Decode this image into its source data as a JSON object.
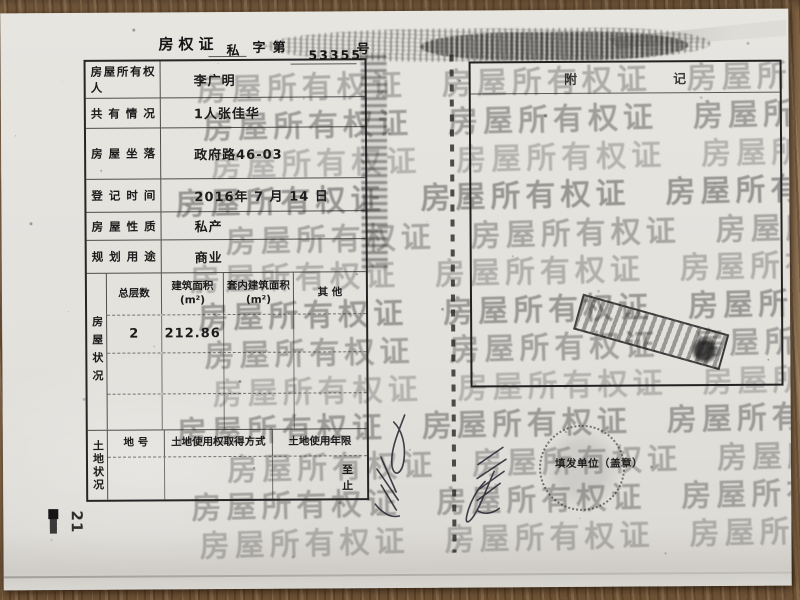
{
  "header": {
    "title": "房权证",
    "category": "私",
    "zi_di": "字第",
    "serial": "53355",
    "hao": "号"
  },
  "owner_table": {
    "rows": [
      {
        "label": "房屋所有权人",
        "value": "李广明"
      },
      {
        "label": "共有情况",
        "value": "1人张佳华"
      },
      {
        "label": "房屋坐落",
        "value": "政府路46-03"
      },
      {
        "label": "登记时间",
        "value": "2016年 7 月 14 日"
      },
      {
        "label": "房屋性质",
        "value": "私产"
      },
      {
        "label": "规划用途",
        "value": "商业"
      }
    ]
  },
  "housing": {
    "side_label": "房屋状况",
    "headers": [
      "总层数",
      "建筑面积\n(m²)",
      "套内建筑面积\n(m²)",
      "其 他"
    ],
    "data_row": {
      "total_floors": "2",
      "built_area": "212.86",
      "inner_area": "",
      "other": ""
    }
  },
  "land": {
    "side_label": "土地状况",
    "headers": [
      "地 号",
      "土地使用权取得方式",
      "土地使用年限"
    ],
    "term_from": "至",
    "term_end": "止"
  },
  "annex": {
    "char1": "附",
    "char2": "记"
  },
  "watermark": {
    "text": "房屋所有权证"
  },
  "stamps": {
    "issuer_seal_label": "填发单位（盖章）"
  },
  "page_number": "21",
  "colors": {
    "paper": "#e3e1dc",
    "wood": "#8a6c4d",
    "ink": "#1c1c1c"
  }
}
